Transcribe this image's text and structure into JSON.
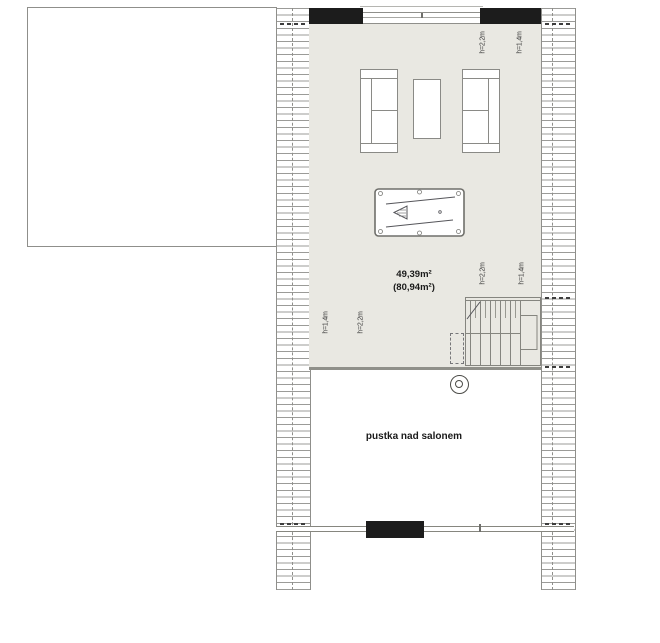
{
  "plan": {
    "title": "attic floor plan",
    "area_label": {
      "line1": "49,39m²",
      "line2": "(80,94m²)"
    },
    "void_label": "pustka nad salonem",
    "height_labels": {
      "h_22": "h=2,2m",
      "h_14": "h=1,4m"
    },
    "colors": {
      "floor": "#e9e8e2",
      "wall": "#1c1c1c",
      "line_grey": "#8f8f8b",
      "text": "#1a1a1a"
    },
    "rooms": [
      {
        "name": "attic-room",
        "area_m2": "49,39",
        "gross_area_m2": "80,94"
      },
      {
        "name": "void-above-living-room",
        "label": "pustka nad salonem"
      }
    ]
  }
}
